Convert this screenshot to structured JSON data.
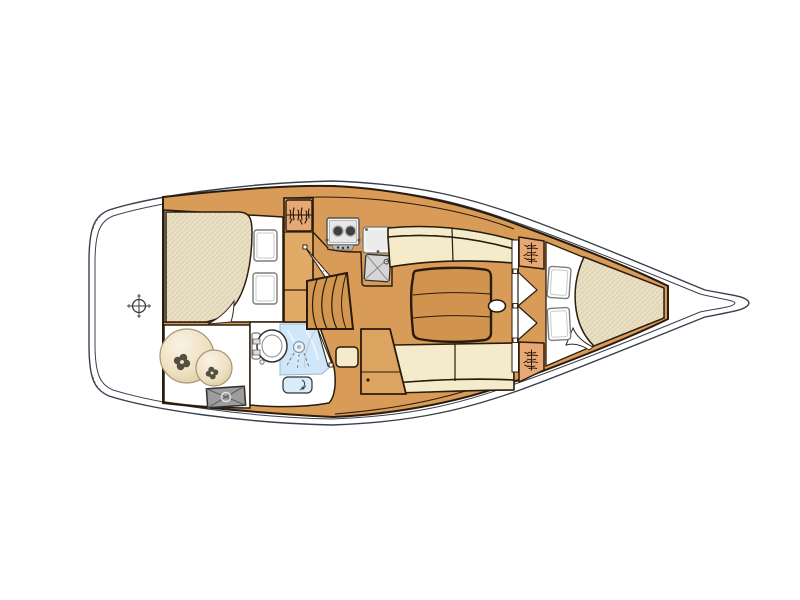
{
  "image": {
    "description": "Top-down interior layout plan of a sailing yacht hull, bow pointing right",
    "width_px": 800,
    "height_px": 600,
    "background": "#ffffff",
    "visible_text": []
  },
  "colors": {
    "hull_line": "#39404d",
    "outline_dark": "#2a1b0c",
    "wood_base": "#d89b58",
    "wood_light": "#e2aa67",
    "wood_table": "#d0944f",
    "cushion_cream": "#f3ebc9",
    "mattress_beige": "#ebe1c6",
    "locker_orange": "#e8a873",
    "shower_blue": "#cfe7f8",
    "basin_blue": "#d8ecf9",
    "metal_gray": "#d6d6d6",
    "hatch_gray": "#9c9c9c",
    "white": "#ffffff"
  },
  "areas": [
    {
      "name": "stern-deck",
      "feature": "centerline-crosshair-marker"
    },
    {
      "name": "aft-cabin",
      "feature": "double-berth, two-pillows"
    },
    {
      "name": "technical-compartment",
      "feature": "two-round-tanks, engine-hatch"
    },
    {
      "name": "head",
      "feature": "toilet, shower, washbasin, door-swing"
    },
    {
      "name": "galley",
      "feature": "two-burner-stove, sink, icebox-sink, hanging-locker"
    },
    {
      "name": "companionway",
      "feature": "steps, aft-cabin-door-swing"
    },
    {
      "name": "saloon",
      "feature": "port-settee, starboard-settee, table-with-handle, nav-seat, storage-cabinet"
    },
    {
      "name": "forward-cabin",
      "feature": "double-doors, two-hanging-lockers, v-berth, two-pillows"
    },
    {
      "name": "anchor-locker",
      "feature": "empty-bow-space"
    }
  ],
  "icon_names": [
    "crosshair-icon",
    "hanger-squiggle-icon",
    "valve-clover-icon",
    "shower-head-icon",
    "faucet-icon",
    "burner-icon",
    "hinge-dot-icon"
  ]
}
